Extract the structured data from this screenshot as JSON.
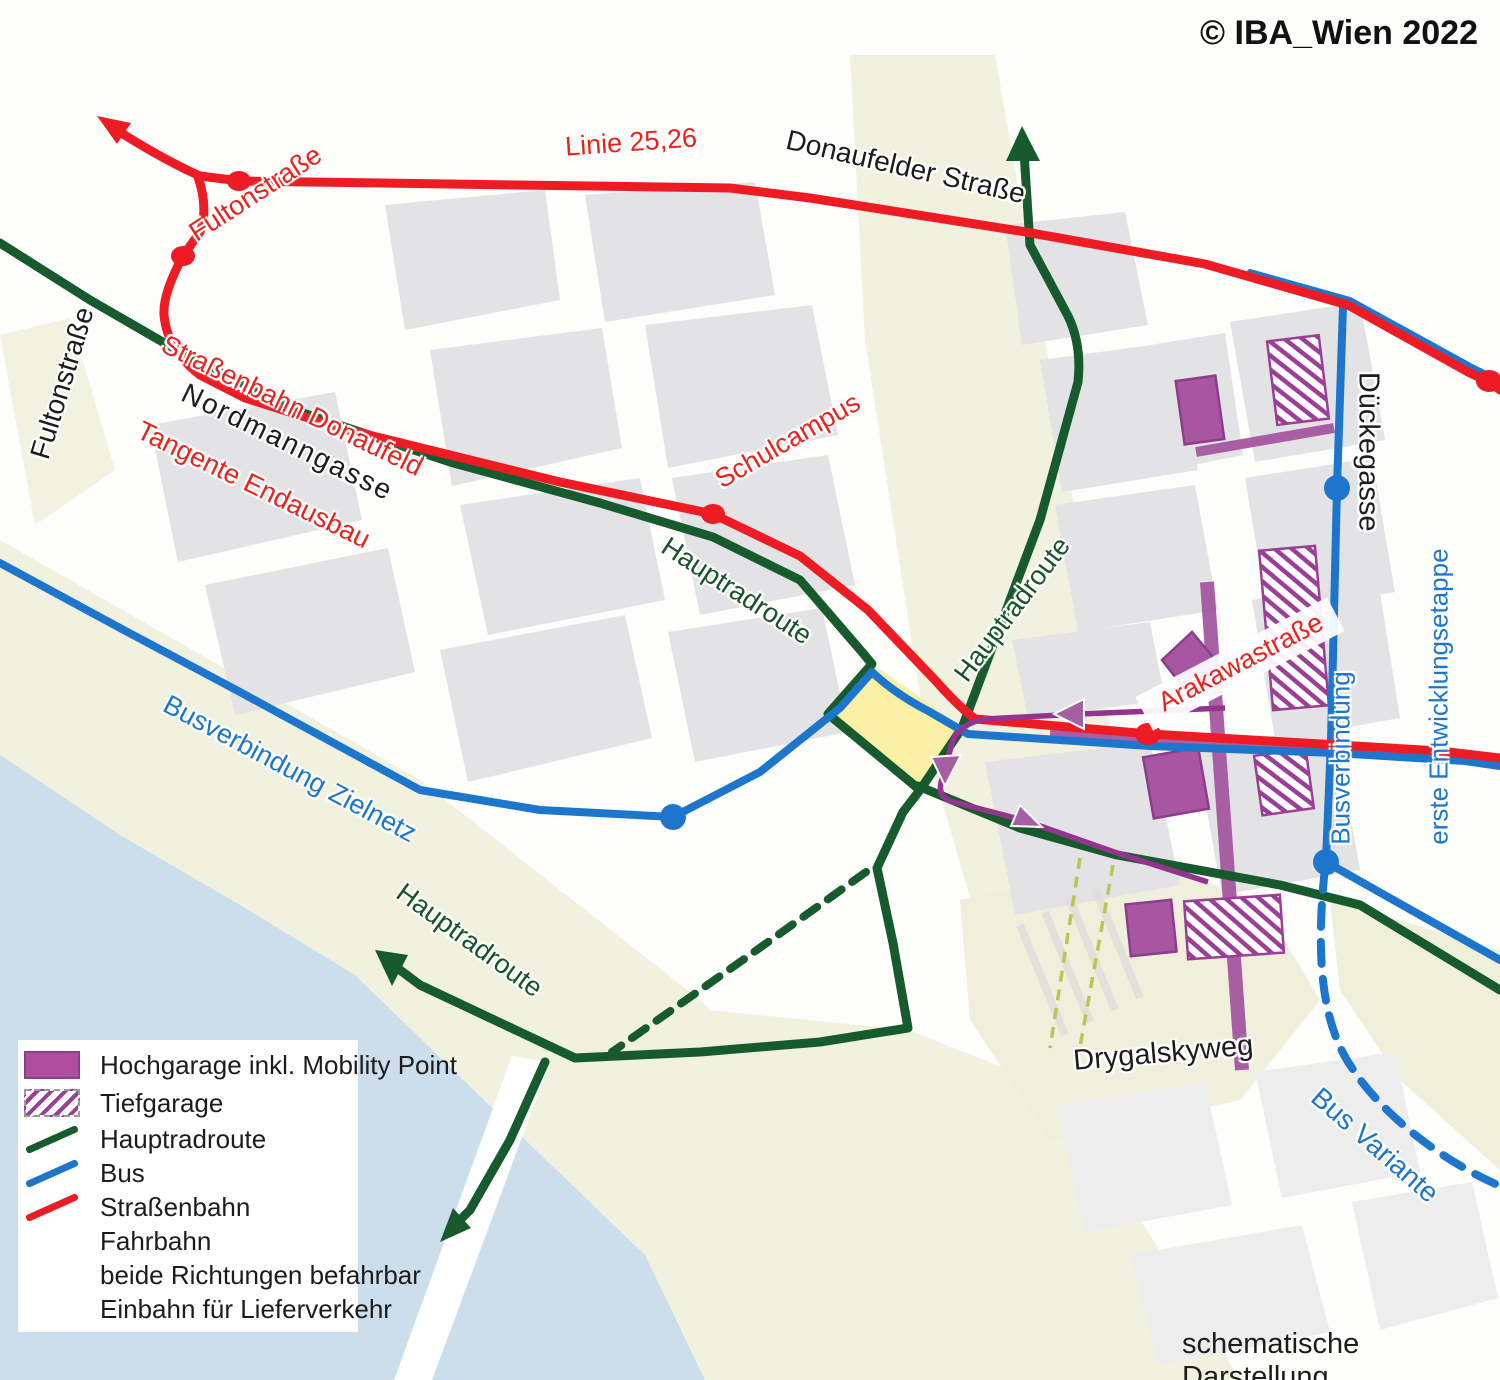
{
  "copyright": "© IBA_Wien 2022",
  "footnote": "schematische Darstellung",
  "map_labels": {
    "linie_25_26": "Linie 25,26",
    "donaufelder_strasse": "Donaufelder Straße",
    "fultonstrasse_red": "Fultonstraße",
    "fultonstrasse_black": "Fultonstraße",
    "tangente_line1": "Straßenbahn Donaufeld",
    "tangente_line2": "Tangente Endausbau",
    "nordmanngasse": "Nordmanngasse",
    "schulcampus": "Schulcampus",
    "hauptradroute_nw": "Hauptradroute",
    "hauptradroute_center": "Hauptradroute",
    "hauptradroute_sw": "Hauptradroute",
    "busverbindung_zielnetz": "Busverbindung Zielnetz",
    "arakawastrasse": "Arakawastraße",
    "dueckegasse": "Dückegasse",
    "busverbindung_erste_line1": "Busverbindung",
    "busverbindung_erste_line2": "erste Entwicklungsetappe",
    "drygalskyweg": "Drygalskyweg",
    "bus_variante": "Bus Variante"
  },
  "legend": {
    "items": [
      {
        "label": "Hochgarage inkl. Mobility Point",
        "swatch": "hochgarage-purple-rect"
      },
      {
        "label": "Tiefgarage",
        "swatch": "tiefgarage-hatched-rect"
      },
      {
        "label": "Hauptradroute",
        "swatch": "green-line"
      },
      {
        "label": "Bus",
        "swatch": "blue-line"
      },
      {
        "label": "Straßenbahn",
        "swatch": "red-line"
      },
      {
        "label": "Fahrbahn",
        "swatch": "none"
      },
      {
        "label": "beide Richtungen befahrbar",
        "swatch": "none"
      },
      {
        "label": "Einbahn für Lieferverkehr",
        "swatch": "none"
      }
    ]
  },
  "colors": {
    "tram_red": "#ed1c24",
    "bike_green": "#175a2e",
    "bus_blue": "#1d76cc",
    "garage_purple": "#a4549e",
    "oneway_purple": "#93348f",
    "plaza_yellow": "#f9efa5",
    "water_blue": "#ccdeeb",
    "block_gray": "#e3e3e5",
    "cream": "#f1f1df"
  }
}
